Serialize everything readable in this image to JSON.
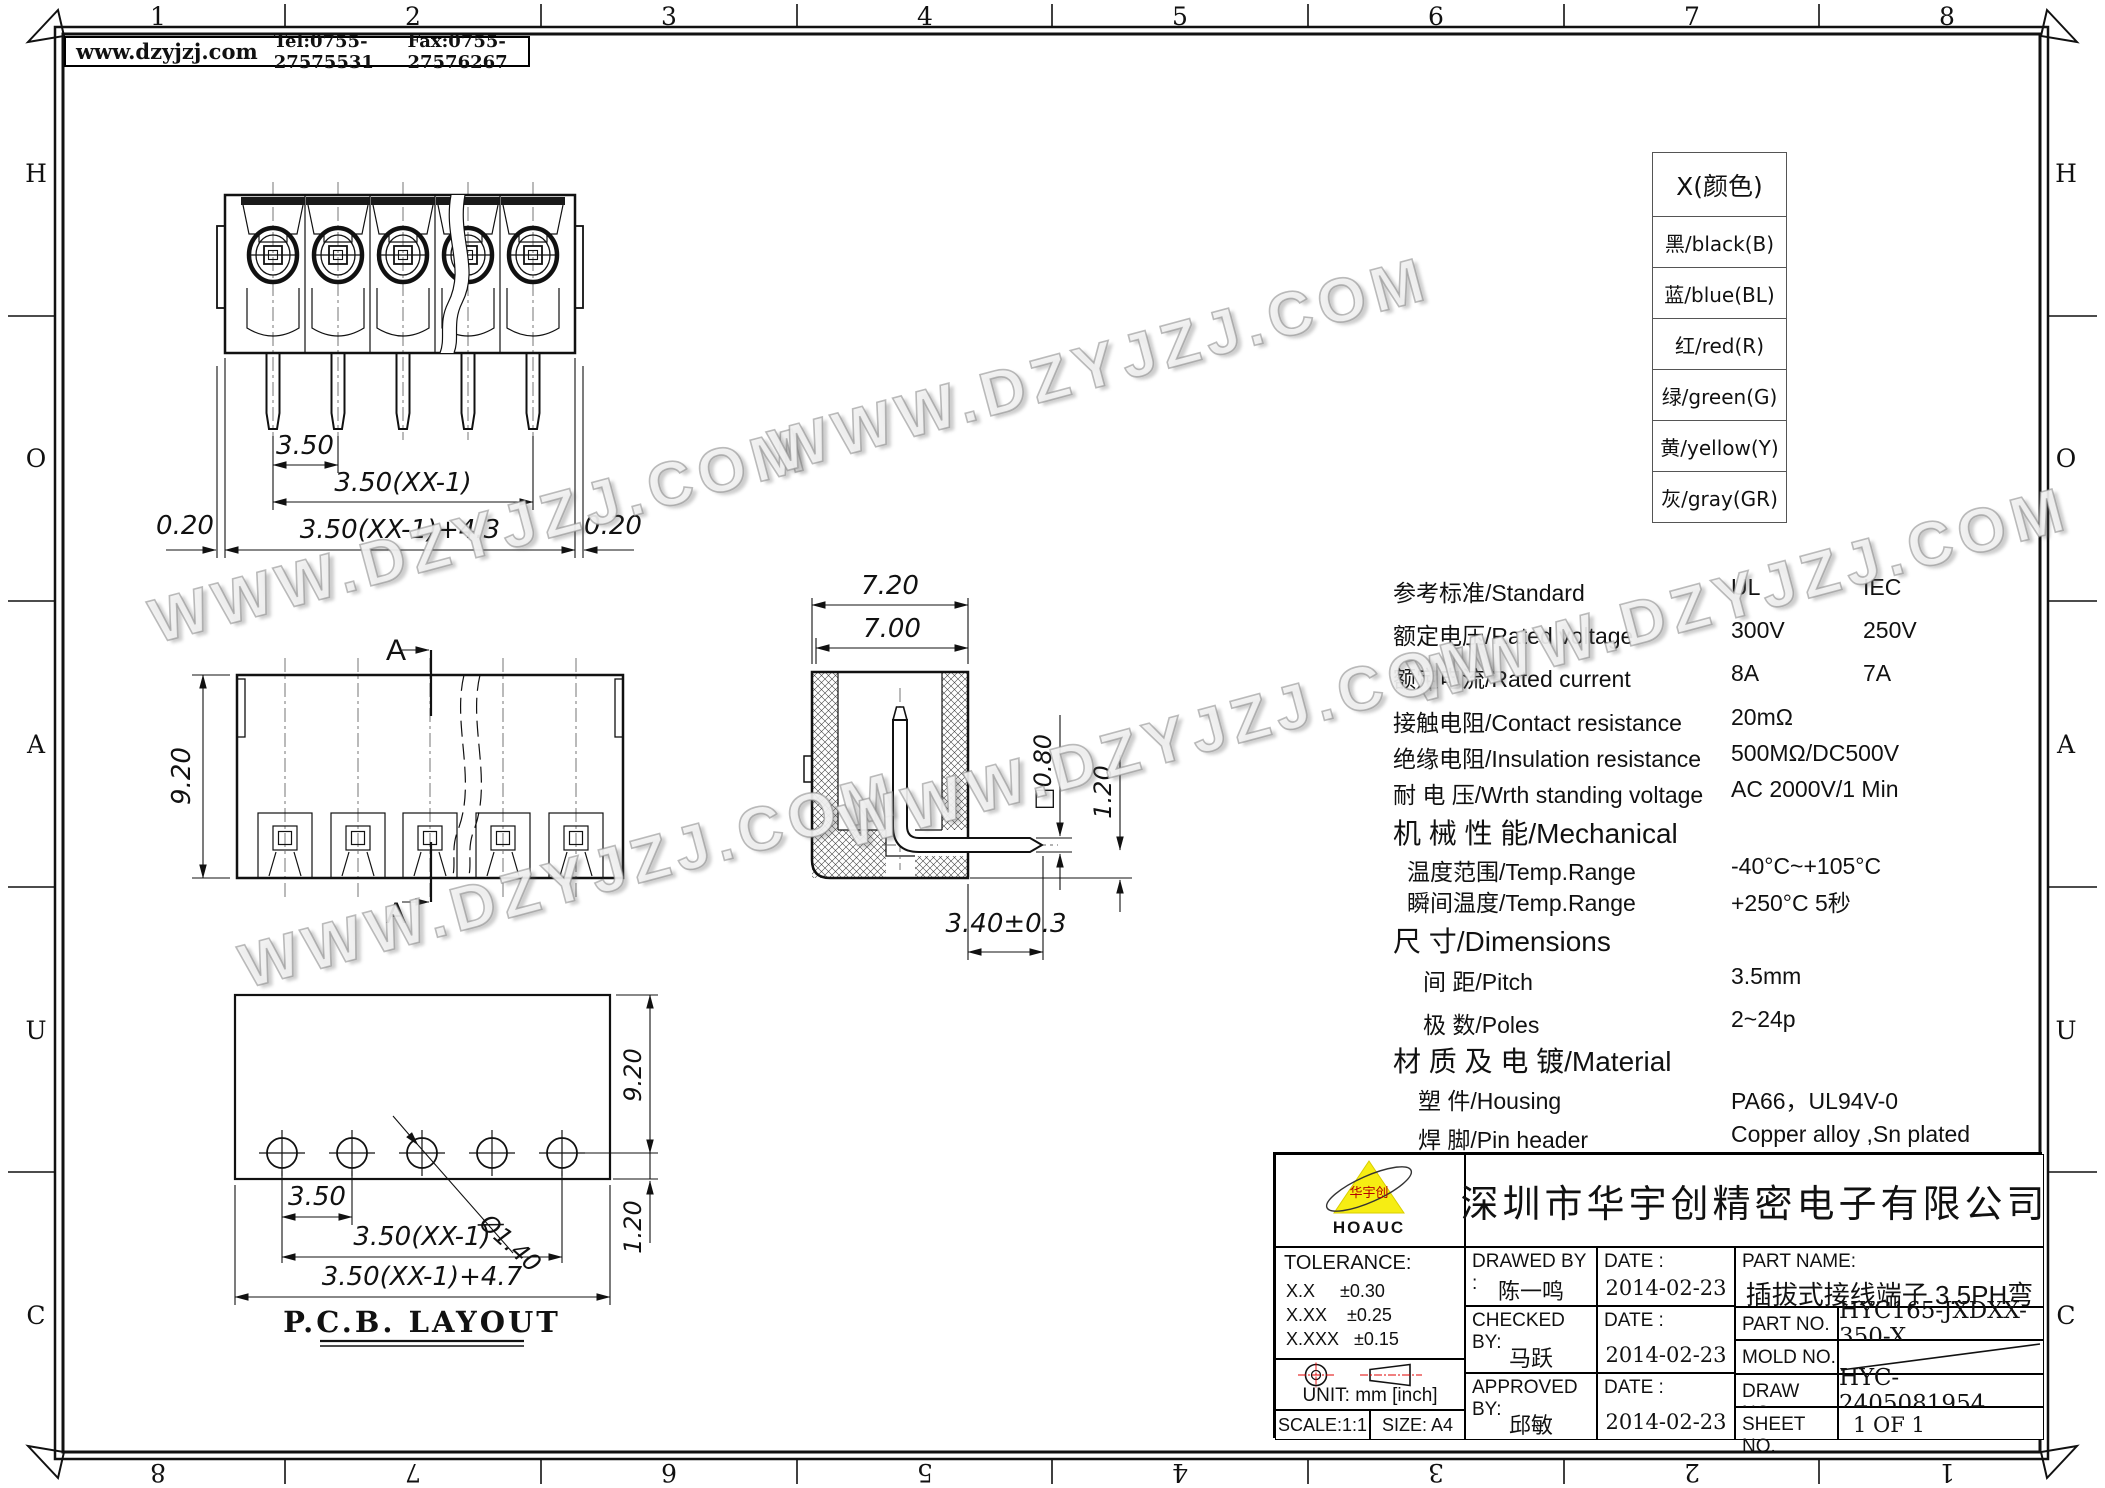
{
  "sheet": {
    "zones_top": [
      "1",
      "2",
      "3",
      "4",
      "5",
      "6",
      "7",
      "8"
    ],
    "zones_bottom": [
      "8",
      "7",
      "6",
      "5",
      "4",
      "3",
      "2",
      "1"
    ],
    "zones_left": [
      "H",
      "O",
      "A",
      "U",
      "C"
    ],
    "zones_right": [
      "H",
      "O",
      "A",
      "U",
      "C"
    ]
  },
  "header": {
    "website": "www.dzyjzj.com",
    "tel": "Tel:0755-27575531",
    "fax": "Fax:0755-27576267"
  },
  "watermark": {
    "text": "WWW.DZYJZJ.COM"
  },
  "color_table": {
    "title": "X(颜色)",
    "rows": [
      "黑/black(B)",
      "蓝/blue(BL)",
      "红/red(R)",
      "绿/green(G)",
      "黄/yellow(Y)",
      "灰/gray(GR)"
    ]
  },
  "specs": {
    "rows": [
      {
        "label": "参考标准/Standard",
        "v1": "UL",
        "v2": "IEC"
      },
      {
        "label": "额定电压/Rated voltage",
        "v1": "300V",
        "v2": "250V"
      },
      {
        "label": "额定电流/Rated current",
        "v1": "8A",
        "v2": "7A"
      },
      {
        "label": "接触电阻/Contact resistance",
        "v1": "20mΩ",
        "v2": ""
      },
      {
        "label": "绝缘电阻/Insulation resistance",
        "v1": "500MΩ/DC500V",
        "v2": ""
      },
      {
        "label": "耐 电 压/Wrth standing voltage",
        "v1": "AC 2000V/1 Min",
        "v2": ""
      },
      {
        "label": "机 械 性 能/Mechanical",
        "v1": "",
        "v2": ""
      },
      {
        "label": "温度范围/Temp.Range",
        "v1": "-40°C~+105°C",
        "v2": ""
      },
      {
        "label": "瞬间温度/Temp.Range",
        "v1": "+250°C   5秒",
        "v2": ""
      },
      {
        "label": "尺   寸/Dimensions",
        "v1": "",
        "v2": ""
      },
      {
        "label": "间 距/Pitch",
        "v1": "3.5mm",
        "v2": ""
      },
      {
        "label": "极 数/Poles",
        "v1": "2~24p",
        "v2": ""
      },
      {
        "label": "材 质 及 电 镀/Material",
        "v1": "",
        "v2": ""
      },
      {
        "label": "塑 件/Housing",
        "v1": "PA66，UL94V-0",
        "v2": ""
      },
      {
        "label": "焊 脚/Pin header",
        "v1": "Copper alloy ,Sn plated",
        "v2": ""
      }
    ]
  },
  "dims": {
    "front": {
      "pitch": "3.50",
      "span": "3.50(XX-1)",
      "overall": "3.50(XX-1)+4.3",
      "edge_left": "0.20",
      "edge_right": "0.20"
    },
    "top": {
      "height": "9.20",
      "section": "A"
    },
    "section": {
      "w_outer": "7.20",
      "w_inner": "7.00",
      "pin_square": "□0.80",
      "pin_offset": "1.20",
      "pin_length": "3.40±0.3"
    },
    "pcb": {
      "pitch": "3.50",
      "span": "3.50(XX-1)",
      "overall": "3.50(XX-1)+4.7",
      "hole_dia": "Ø1.40",
      "height": "9.20",
      "offset": "1.20",
      "title": "P.C.B. LAYOUT"
    }
  },
  "title_block": {
    "company": "深圳市华宇创精密电子有限公司",
    "logo": {
      "brand": "HOAUC",
      "mark": "华宇创"
    },
    "tolerance": {
      "label": "TOLERANCE:",
      "lines": "X.X     ±0.30\nX.XX    ±0.25\nX.XXX   ±0.15",
      "angles": "X.°  ±2°      X.X°  ±0.5°"
    },
    "unit": "UNIT:  mm  [inch]",
    "scale": "SCALE:1:1",
    "size": "SIZE:  A4",
    "sign": {
      "date_label": "DATE :",
      "drawed_label": "DRAWED  BY :",
      "drawed_name": "陈一鸣",
      "drawed_date": "2014-02-23",
      "checked_label": "CHECKED  BY:",
      "checked_name": "马跃",
      "checked_date": "2014-02-23",
      "approved_label": "APPROVED  BY:",
      "approved_name": "邱敏",
      "approved_date": "2014-02-23"
    },
    "part": {
      "name_label": "PART  NAME:",
      "name": "插拔式接线端子 3.5PH弯针",
      "no_label": "PART  NO.",
      "no": "HYC165-JXDXX-350-X",
      "mold_label": "MOLD  NO.",
      "draw_label": "DRAW  NO:",
      "draw": "HYC-2405081954",
      "sheet_label": "SHEET  NO.",
      "sheet": "1 OF 1"
    }
  }
}
